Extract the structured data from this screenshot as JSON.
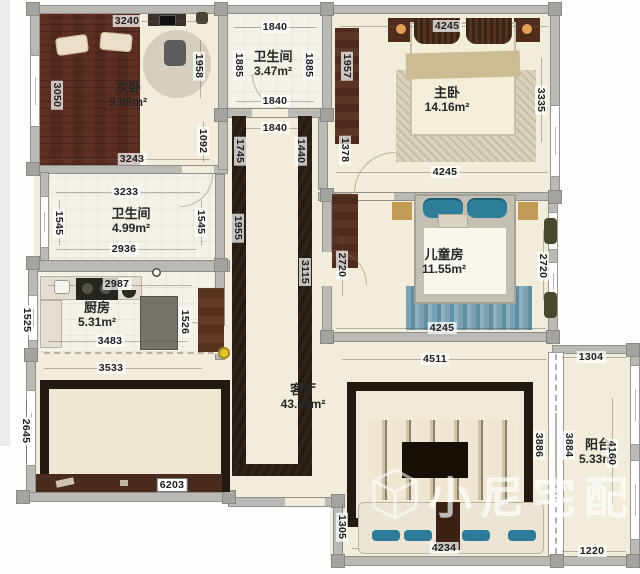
{
  "watermark": {
    "text": "小尼宅配"
  },
  "rooms": {
    "second_bedroom": {
      "name": "次卧",
      "area": "9.88m²",
      "dims": {
        "top": "3240",
        "left": "3050",
        "right_top": "1958",
        "right_bottom": "1092",
        "bottom": "3243"
      }
    },
    "bathroom_top": {
      "name": "卫生间",
      "area": "3.47m²",
      "dims": {
        "top": "1840",
        "left": "1885",
        "right": "1885",
        "bottom": "1840",
        "passage": "1840"
      }
    },
    "master_bedroom": {
      "name": "主卧",
      "area": "14.16m²",
      "dims": {
        "top": "4245",
        "left_top": "1957",
        "left_bottom": "1378",
        "right": "3335",
        "bottom": "4245"
      }
    },
    "bathroom_mid": {
      "name": "卫生间",
      "area": "4.99m²",
      "dims": {
        "top": "3233",
        "left": "1545",
        "right": "1545",
        "bottom": "2936"
      }
    },
    "kitchen": {
      "name": "厨房",
      "area": "5.31m²",
      "dims": {
        "top": "2987",
        "left": "1525",
        "right": "1526",
        "bottom": "3483"
      }
    },
    "hallway": {
      "dims": {
        "left_top": "1745",
        "right_top": "1440",
        "left_mid": "1955",
        "right_mid": "3115"
      }
    },
    "dining": {
      "dims": {
        "top": "3533",
        "left": "2645",
        "bottom": "6203"
      }
    },
    "living": {
      "name": "客厅",
      "area": "43.69m²",
      "dims": {
        "tv_top": "4511",
        "right": "3886",
        "sofa_left": "1305",
        "sofa_bottom": "4234"
      }
    },
    "kids_room": {
      "name": "儿童房",
      "area": "11.55m²",
      "dims": {
        "left": "2720",
        "right": "2720",
        "bottom": "4245"
      }
    },
    "balcony": {
      "name": "阳台",
      "area": "5.33m²",
      "dims": {
        "top": "1304",
        "left": "3884",
        "right": "4160",
        "bottom": "1220"
      }
    }
  }
}
